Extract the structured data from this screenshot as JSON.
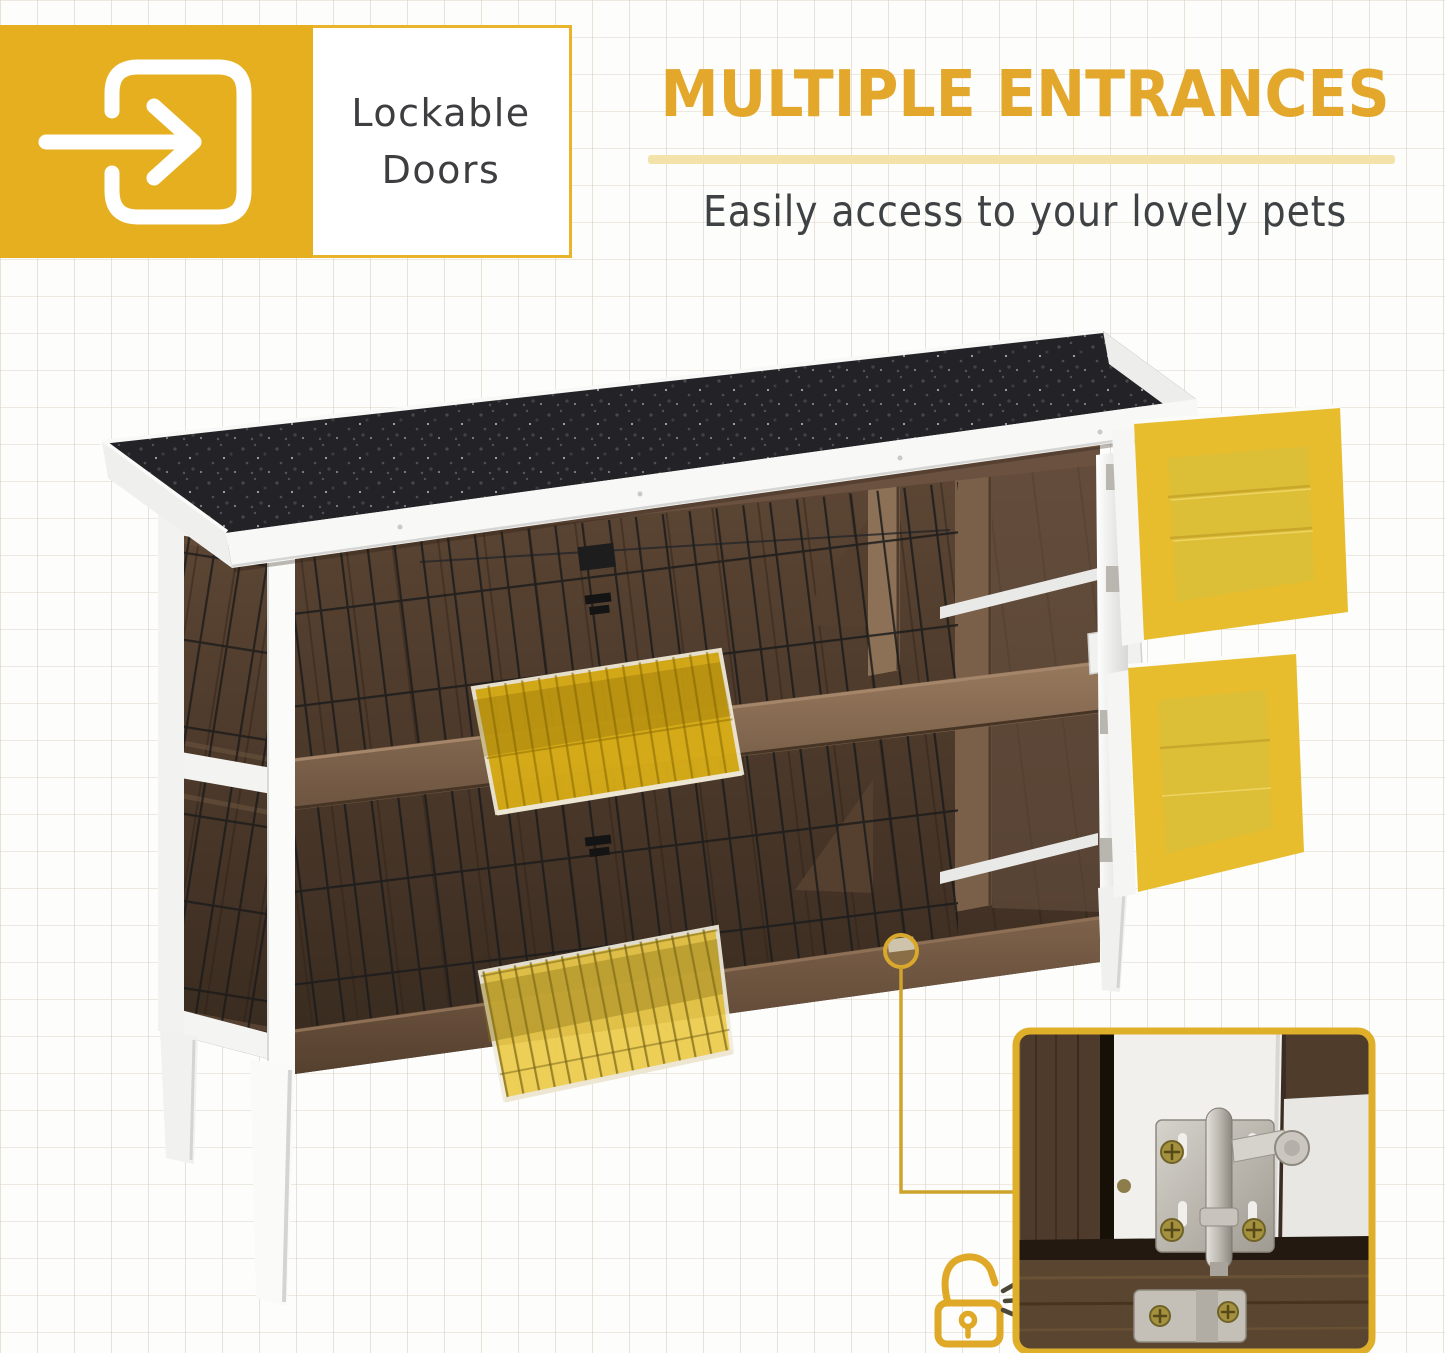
{
  "badge": {
    "icon": "door-enter-arrow-icon",
    "label_line1": "Lockable",
    "label_line2": "Doors"
  },
  "headline": {
    "title": "MULTIPLE ENTRANCES",
    "subtitle": "Easily access to your lovely pets"
  },
  "photo": {
    "subject": "two-story wooden rabbit hutch with black felt roof, wire mesh panels and white trim",
    "highlighted_parts": [
      "upper right solid wood door (open)",
      "lower right solid wood door (open)",
      "upper front wire mesh door (open)",
      "lower front wire mesh door (open)"
    ],
    "marker": "circle around door latch",
    "inset": "close-up of metal slide-bolt latch on white door frame"
  },
  "icons": {
    "badge": "door-enter-arrow-icon",
    "lock": "unlocked-padlock-icon",
    "sound": "click-sound-waves-icon"
  },
  "colors": {
    "accent_gold": "#E2A72B",
    "badge_yellow": "#E6AF1F",
    "underline_yellow": "#F3E3AB",
    "door_highlight": "#E7BD2E",
    "flap_highlight_upper": "#D9AE17",
    "flap_highlight_lower": "#ECCB4A",
    "text_dark": "#3F4245",
    "roof_black": "#232327",
    "wood_brown": "#5C4433",
    "trim_white": "#FFFFFF",
    "inset_border": "#DFAF2A"
  }
}
